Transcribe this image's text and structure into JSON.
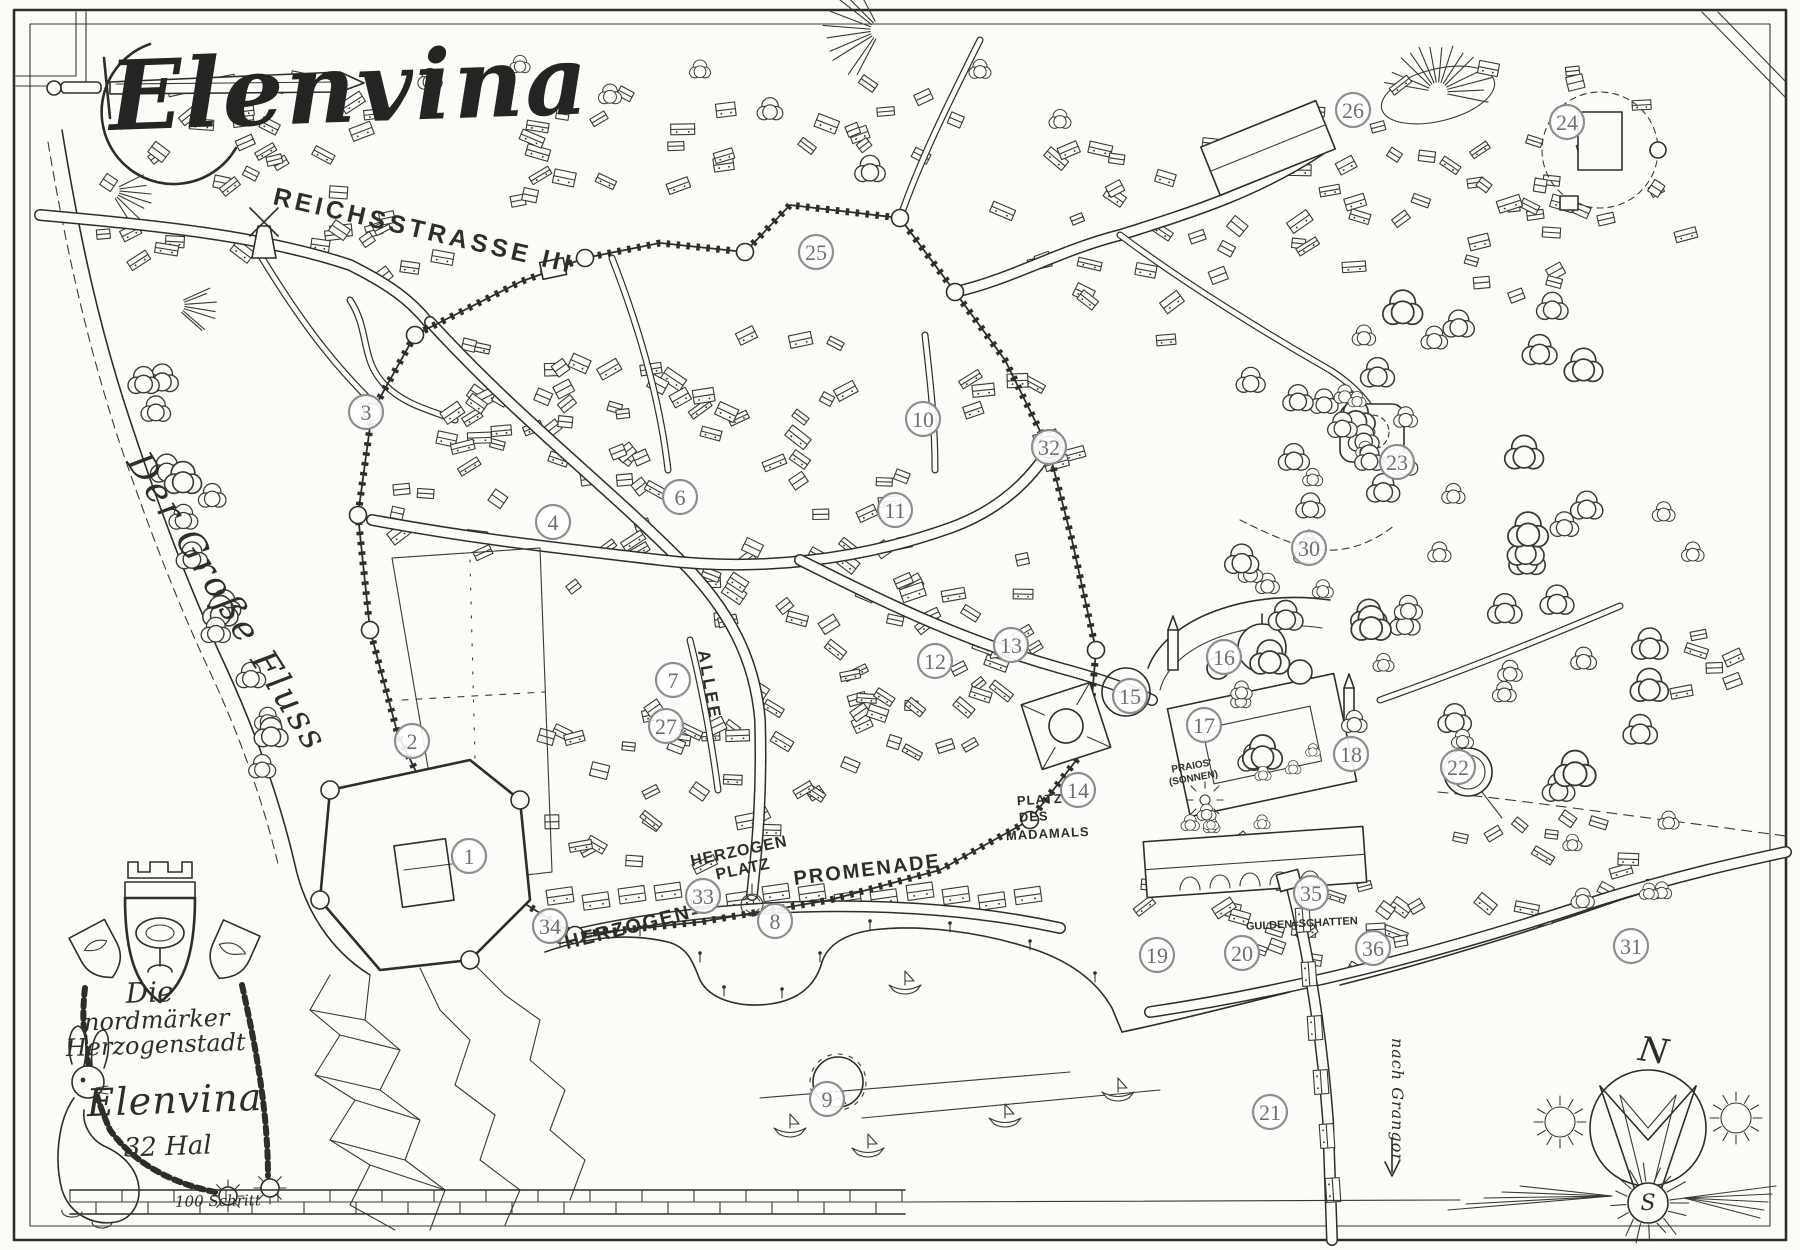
{
  "map": {
    "title": "Elenvina",
    "ink_color": "#2f2d2b",
    "paper_color": "#fcfbf7",
    "marker_stroke_color": "#8e8e8e",
    "marker_text_color": "#6f6f6f"
  },
  "cartouche": {
    "line1": "Die",
    "line2": "nordmärker",
    "line3": "Herzogenstadt",
    "city_name": "Elenvina",
    "date": "32 Hal"
  },
  "scale_bar": {
    "label": "100 Schritt"
  },
  "compass": {
    "north": "N",
    "south": "S"
  },
  "labels": [
    {
      "id": "title",
      "text": "Elenvina",
      "x": 110,
      "y": 130,
      "rot": -2,
      "size": 96,
      "cls": "title",
      "sp": 2,
      "anchor": "start"
    },
    {
      "id": "reichsstrasse",
      "text": "REICHSSTRASSE III",
      "x": 272,
      "y": 204,
      "rot": 13,
      "size": 25,
      "cls": "caps",
      "sp": 4,
      "anchor": "start"
    },
    {
      "id": "fluss",
      "text": "Der Große Fluss",
      "x": 126,
      "y": 462,
      "rot": 58,
      "size": 36,
      "cls": "script",
      "sp": 3,
      "anchor": "start"
    },
    {
      "id": "allee",
      "text": "ALLEE",
      "x": 704,
      "y": 686,
      "rot": 80,
      "size": 17,
      "cls": "caps",
      "sp": 3,
      "anchor": "middle"
    },
    {
      "id": "hzplatz1",
      "text": "HERZOGEN",
      "x": 740,
      "y": 856,
      "rot": -12,
      "size": 16,
      "cls": "caps",
      "sp": 1,
      "anchor": "middle"
    },
    {
      "id": "hzplatz2",
      "text": "PLATZ",
      "x": 744,
      "y": 874,
      "rot": -12,
      "size": 16,
      "cls": "caps",
      "sp": 1,
      "anchor": "middle"
    },
    {
      "id": "hzprom",
      "text": "HERZOGEN=",
      "x": 636,
      "y": 932,
      "rot": -14,
      "size": 20,
      "cls": "caps",
      "sp": 2,
      "anchor": "middle"
    },
    {
      "id": "promenade",
      "text": "PROMENADE",
      "x": 868,
      "y": 876,
      "rot": -7,
      "size": 20,
      "cls": "caps",
      "sp": 2,
      "anchor": "middle"
    },
    {
      "id": "madamals1",
      "text": "PLATZ",
      "x": 1040,
      "y": 804,
      "rot": -3,
      "size": 13,
      "cls": "caps",
      "sp": 1,
      "anchor": "middle"
    },
    {
      "id": "madamals2",
      "text": "DES",
      "x": 1034,
      "y": 821,
      "rot": -3,
      "size": 13,
      "cls": "caps",
      "sp": 1,
      "anchor": "middle"
    },
    {
      "id": "madamals3",
      "text": "MADAMALS",
      "x": 1048,
      "y": 838,
      "rot": -3,
      "size": 13,
      "cls": "caps",
      "sp": 1,
      "anchor": "middle"
    },
    {
      "id": "praios1",
      "text": "PRAIOS'",
      "x": 1192,
      "y": 769,
      "rot": -10,
      "size": 10,
      "cls": "caps",
      "sp": 0,
      "anchor": "middle"
    },
    {
      "id": "praios2",
      "text": "(SONNEN)",
      "x": 1194,
      "y": 781,
      "rot": -10,
      "size": 10,
      "cls": "caps",
      "sp": 0,
      "anchor": "middle"
    },
    {
      "id": "gulden",
      "text": "GULDEN=SCHATTEN",
      "x": 1302,
      "y": 927,
      "rot": -3,
      "size": 11,
      "cls": "caps",
      "sp": 0,
      "anchor": "middle"
    },
    {
      "id": "grangor",
      "text": "nach Grangor",
      "x": 1392,
      "y": 1100,
      "rot": 90,
      "size": 16,
      "cls": "script",
      "sp": 1,
      "anchor": "middle"
    },
    {
      "id": "cart1",
      "text": "Die",
      "x": 150,
      "y": 1002,
      "rot": -2,
      "size": 28,
      "cls": "script",
      "sp": 0,
      "anchor": "middle"
    },
    {
      "id": "cart2",
      "text": "nordmärker",
      "x": 157,
      "y": 1028,
      "rot": -2,
      "size": 24,
      "cls": "script",
      "sp": 0,
      "anchor": "middle"
    },
    {
      "id": "cart3",
      "text": "Herzogenstadt",
      "x": 156,
      "y": 1053,
      "rot": -2,
      "size": 24,
      "cls": "script",
      "sp": 0,
      "anchor": "middle"
    },
    {
      "id": "cartname",
      "text": "Elenvina",
      "x": 175,
      "y": 1113,
      "rot": -2,
      "size": 38,
      "cls": "script",
      "sp": 1,
      "anchor": "middle"
    },
    {
      "id": "cartdate",
      "text": "32 Hal",
      "x": 168,
      "y": 1155,
      "rot": -2,
      "size": 26,
      "cls": "script",
      "sp": 0,
      "anchor": "middle"
    },
    {
      "id": "scalelbl",
      "text": "100 Schritt",
      "x": 218,
      "y": 1206,
      "rot": -1,
      "size": 15,
      "cls": "script",
      "sp": 0,
      "anchor": "middle"
    },
    {
      "id": "compassN",
      "text": "N",
      "x": 1652,
      "y": 1062,
      "rot": 8,
      "size": 34,
      "cls": "script",
      "sp": 0,
      "anchor": "middle"
    },
    {
      "id": "compassS",
      "text": "S",
      "x": 1648,
      "y": 1210,
      "rot": 0,
      "size": 22,
      "cls": "script",
      "sp": 0,
      "anchor": "middle"
    }
  ],
  "markers": [
    {
      "n": "1",
      "x": 469,
      "y": 856
    },
    {
      "n": "2",
      "x": 412,
      "y": 741
    },
    {
      "n": "3",
      "x": 366,
      "y": 412
    },
    {
      "n": "4",
      "x": 553,
      "y": 522
    },
    {
      "n": "6",
      "x": 680,
      "y": 497
    },
    {
      "n": "7",
      "x": 673,
      "y": 680
    },
    {
      "n": "8",
      "x": 775,
      "y": 921
    },
    {
      "n": "9",
      "x": 827,
      "y": 1099
    },
    {
      "n": "10",
      "x": 923,
      "y": 419
    },
    {
      "n": "11",
      "x": 895,
      "y": 510
    },
    {
      "n": "12",
      "x": 935,
      "y": 661
    },
    {
      "n": "13",
      "x": 1011,
      "y": 645
    },
    {
      "n": "14",
      "x": 1078,
      "y": 790
    },
    {
      "n": "15",
      "x": 1130,
      "y": 696
    },
    {
      "n": "16",
      "x": 1224,
      "y": 657
    },
    {
      "n": "17",
      "x": 1204,
      "y": 725
    },
    {
      "n": "18",
      "x": 1351,
      "y": 754
    },
    {
      "n": "19",
      "x": 1157,
      "y": 955
    },
    {
      "n": "20",
      "x": 1242,
      "y": 953
    },
    {
      "n": "21",
      "x": 1270,
      "y": 1112
    },
    {
      "n": "22",
      "x": 1458,
      "y": 767
    },
    {
      "n": "23",
      "x": 1397,
      "y": 462
    },
    {
      "n": "24",
      "x": 1567,
      "y": 122
    },
    {
      "n": "25",
      "x": 816,
      "y": 252
    },
    {
      "n": "26",
      "x": 1353,
      "y": 110
    },
    {
      "n": "27",
      "x": 666,
      "y": 726
    },
    {
      "n": "30",
      "x": 1309,
      "y": 548
    },
    {
      "n": "31",
      "x": 1631,
      "y": 946
    },
    {
      "n": "32",
      "x": 1049,
      "y": 447
    },
    {
      "n": "33",
      "x": 703,
      "y": 896
    },
    {
      "n": "34",
      "x": 550,
      "y": 926
    },
    {
      "n": "35",
      "x": 1311,
      "y": 893
    },
    {
      "n": "36",
      "x": 1373,
      "y": 948
    }
  ]
}
